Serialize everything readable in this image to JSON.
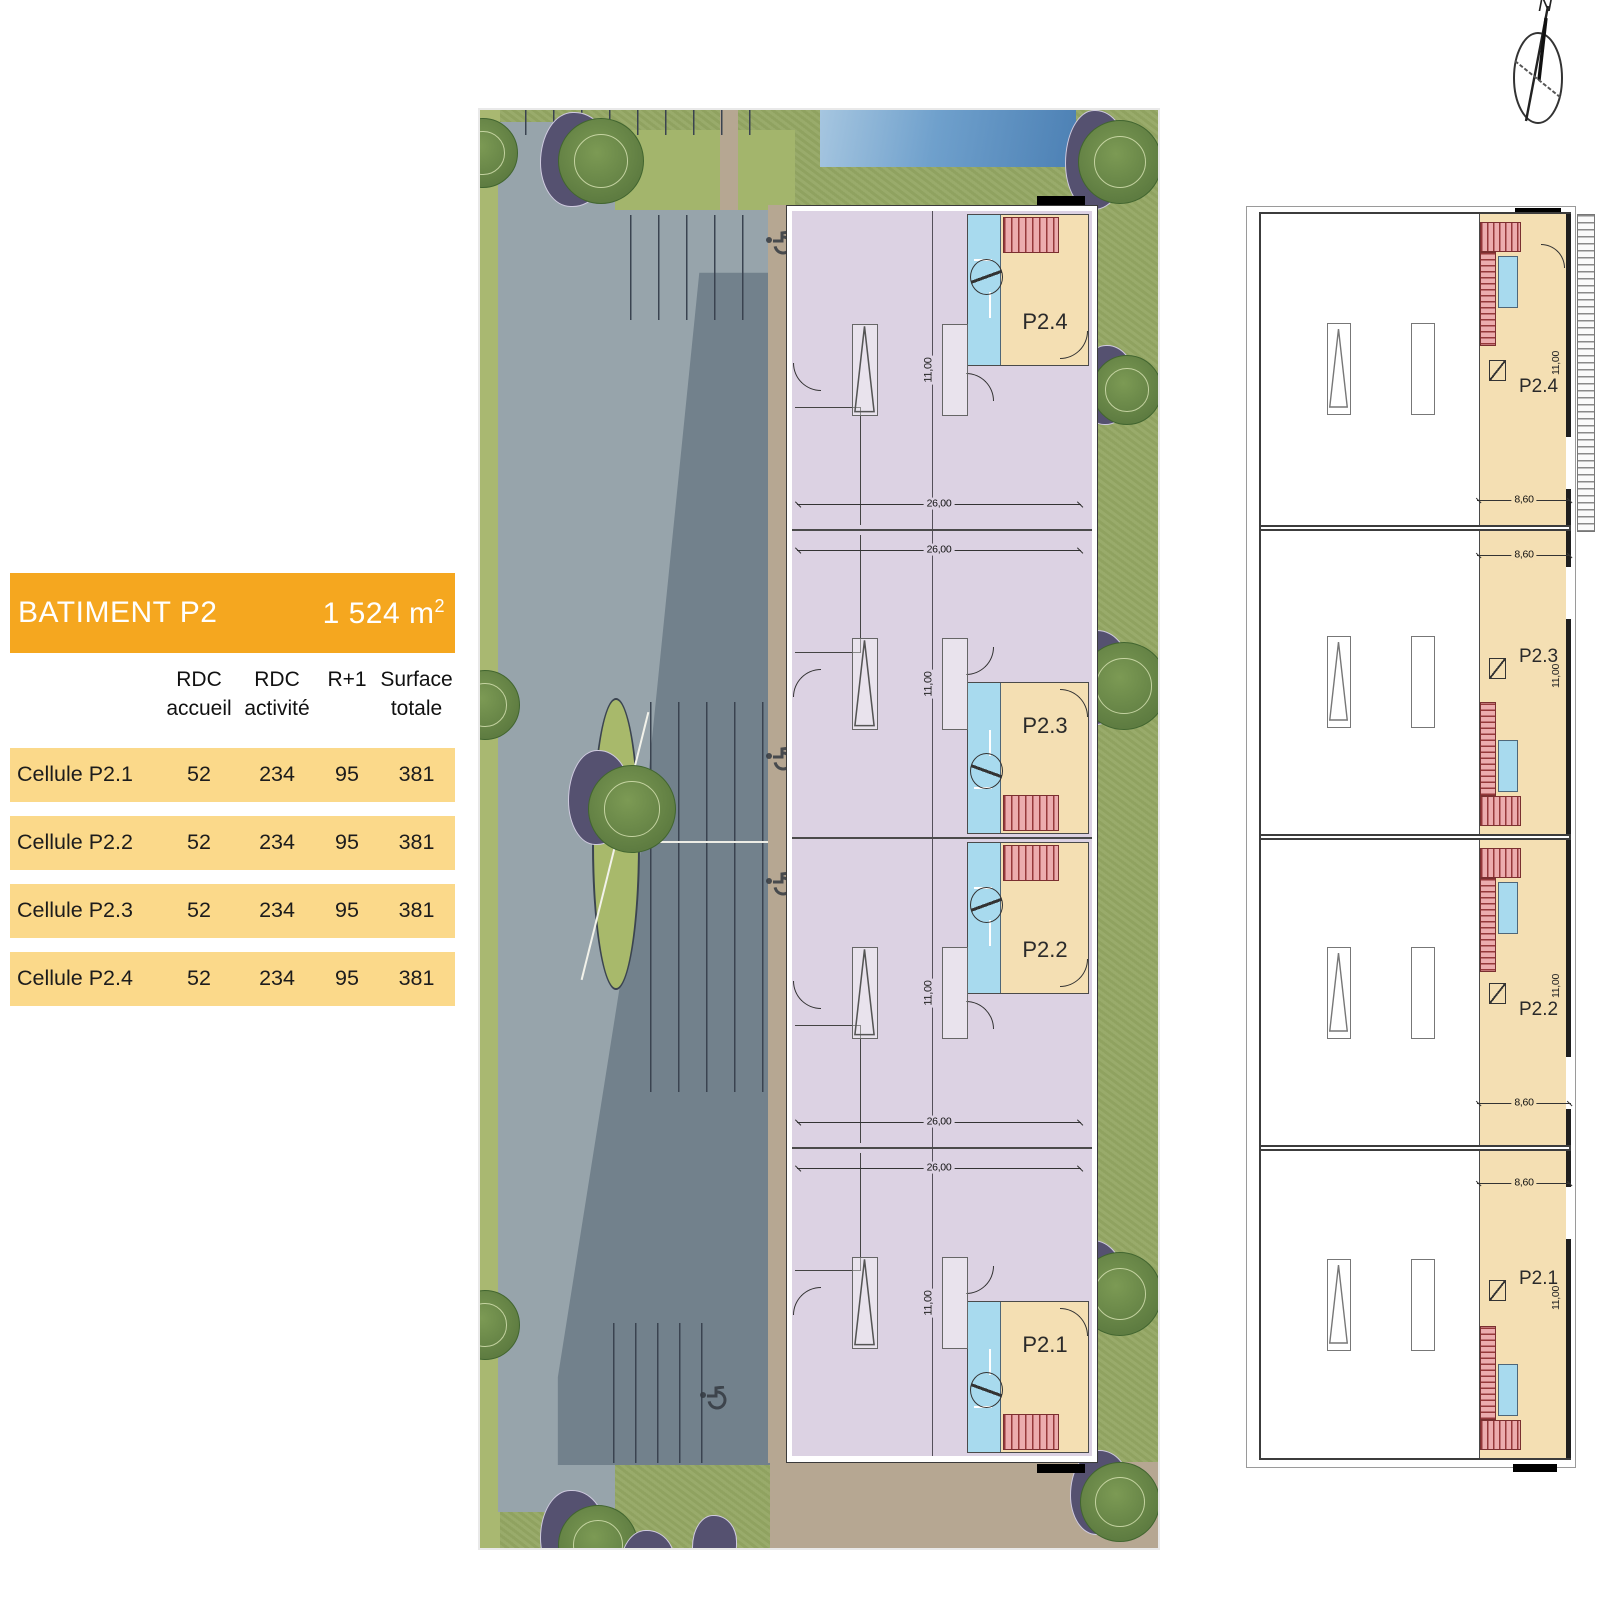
{
  "compass": {
    "north_label": "N"
  },
  "summary_table": {
    "title": "BATIMENT P2",
    "total_area": "1 524 m",
    "total_area_exponent": "2",
    "columns": [
      {
        "line1": "RDC",
        "line2": "accueil"
      },
      {
        "line1": "RDC",
        "line2": "activité"
      },
      {
        "line1": "R+1",
        "line2": ""
      },
      {
        "line1": "Surface",
        "line2": "totale"
      }
    ],
    "rows": [
      {
        "label": "Cellule P2.1",
        "rdc_accueil": "52",
        "rdc_activite": "234",
        "r_plus_1": "95",
        "surface_totale": "381"
      },
      {
        "label": "Cellule P2.2",
        "rdc_accueil": "52",
        "rdc_activite": "234",
        "r_plus_1": "95",
        "surface_totale": "381"
      },
      {
        "label": "Cellule P2.3",
        "rdc_accueil": "52",
        "rdc_activite": "234",
        "r_plus_1": "95",
        "surface_totale": "381"
      },
      {
        "label": "Cellule P2.4",
        "rdc_accueil": "52",
        "rdc_activite": "234",
        "r_plus_1": "95",
        "surface_totale": "381"
      }
    ]
  },
  "site_plan": {
    "cells": [
      {
        "label": "P2.4"
      },
      {
        "label": "P2.3"
      },
      {
        "label": "P2.2"
      },
      {
        "label": "P2.1"
      }
    ],
    "dim_cell_width": "26,00",
    "dim_cell_depth": "11,00"
  },
  "floor_plan_r1": {
    "cells": [
      {
        "label": "P2.4"
      },
      {
        "label": "P2.3"
      },
      {
        "label": "P2.2"
      },
      {
        "label": "P2.1"
      }
    ],
    "dim_cell_width": "8,60",
    "dim_cell_depth": "11,00"
  },
  "colors": {
    "table_header_orange": "#F5A71F",
    "table_row_yellow": "#FBD98A",
    "activity_area_purple": "#DCD2E3",
    "accueil_beige": "#F4DFB3",
    "wc_blue": "#A8DAEE",
    "stair_red": "#ECACAE",
    "grass_green": "#94A763",
    "parking_gray": "#97A4AB",
    "shadow_gray": "#72818C",
    "water_blue": "#4C80B4",
    "tree_shadow_purple": "#555170",
    "path_tan": "#B6A792"
  }
}
